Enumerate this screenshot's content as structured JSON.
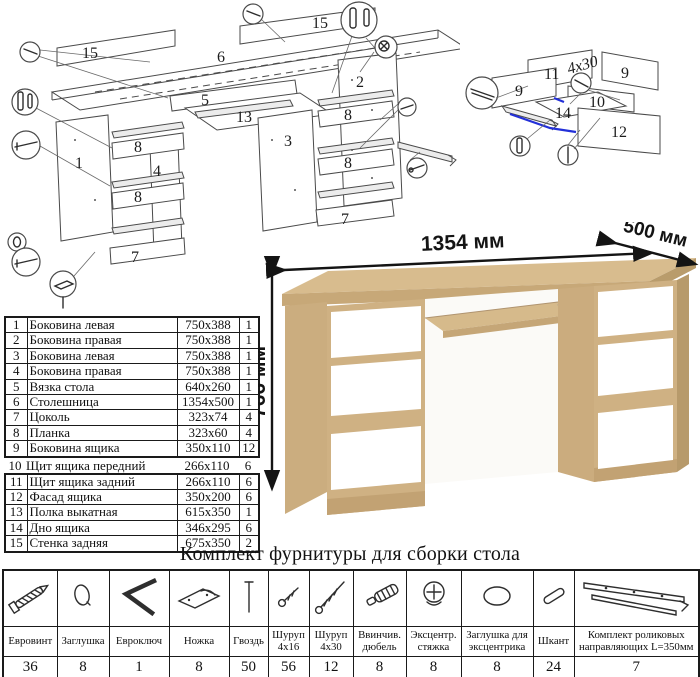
{
  "dimensions": {
    "width_label": "1354 мм",
    "depth_label": "500 мм",
    "height_label": "766 мм"
  },
  "diagram_main": {
    "labels": {
      "back_left": "15",
      "back_right": "15",
      "desktop": "6",
      "tie": "5",
      "side_right": "2",
      "shelf": "13",
      "side_left": "1",
      "partition_mid": "3",
      "partition_left": "4",
      "plank_l1": "8",
      "plank_l2": "8",
      "plank_c1": "8",
      "plank_c2": "8",
      "plinth_left": "7",
      "plinth_center": "7"
    }
  },
  "diagram_drawer": {
    "labels": {
      "back": "11",
      "side_left": "9",
      "side_right": "9",
      "front_inner": "10",
      "bottom": "14",
      "facade": "12"
    },
    "screw_note": "4x30"
  },
  "parts_table": {
    "rows": [
      {
        "num": "1",
        "name": "Боковина левая",
        "size": "750x388",
        "qty": "1"
      },
      {
        "num": "2",
        "name": "Боковина правая",
        "size": "750x388",
        "qty": "1"
      },
      {
        "num": "3",
        "name": "Боковина левая",
        "size": "750x388",
        "qty": "1"
      },
      {
        "num": "4",
        "name": "Боковина правая",
        "size": "750x388",
        "qty": "1"
      },
      {
        "num": "5",
        "name": "Вязка стола",
        "size": "640x260",
        "qty": "1"
      },
      {
        "num": "6",
        "name": "Столешница",
        "size": "1354x500",
        "qty": "1"
      },
      {
        "num": "7",
        "name": "Цоколь",
        "size": "323x74",
        "qty": "4"
      },
      {
        "num": "8",
        "name": "Планка",
        "size": "323x60",
        "qty": "4"
      },
      {
        "num": "9",
        "name": "Боковина ящика",
        "size": "350x110",
        "qty": "12"
      },
      {
        "num": "10",
        "name": "Щит ящика передний",
        "size": "266x110",
        "qty": "6"
      },
      {
        "num": "11",
        "name": "Щит ящика задний",
        "size": "266x110",
        "qty": "6"
      },
      {
        "num": "12",
        "name": "Фасад ящика",
        "size": "350x200",
        "qty": "6"
      },
      {
        "num": "13",
        "name": "Полка выкатная",
        "size": "615x350",
        "qty": "1"
      },
      {
        "num": "14",
        "name": "Дно ящика",
        "size": "346x295",
        "qty": "6"
      },
      {
        "num": "15",
        "name": "Стенка задняя",
        "size": "675x350",
        "qty": "2"
      }
    ]
  },
  "hardware": {
    "title": "Комплект фурнитуры для сборки стола",
    "items": [
      {
        "name": "Евровинт",
        "qty": "36",
        "icon": "euro-screw-icon"
      },
      {
        "name": "Заглушка",
        "qty": "8",
        "icon": "cap-icon"
      },
      {
        "name": "Евроключ",
        "qty": "1",
        "icon": "hex-key-icon"
      },
      {
        "name": "Ножка",
        "qty": "8",
        "icon": "foot-icon"
      },
      {
        "name": "Гвоздь",
        "qty": "50",
        "icon": "nail-icon"
      },
      {
        "name": "Шуруп 4x16",
        "qty": "56",
        "icon": "screw-short-icon"
      },
      {
        "name": "Шуруп 4x30",
        "qty": "12",
        "icon": "screw-long-icon"
      },
      {
        "name": "Ввинчив. дюбель",
        "qty": "8",
        "icon": "dowel-screw-icon"
      },
      {
        "name": "Эксцентр. стяжка",
        "qty": "8",
        "icon": "cam-lock-icon"
      },
      {
        "name": "Заглушка для эксцентрика",
        "qty": "8",
        "icon": "cam-cap-icon"
      },
      {
        "name": "Шкант",
        "qty": "24",
        "icon": "wood-dowel-icon"
      },
      {
        "name": "Комплект роликовых направляющих L=350мм",
        "qty": "7",
        "icon": "drawer-slide-icon"
      }
    ]
  },
  "colors": {
    "oak_top": "#d8bc8e",
    "oak_front": "#cfb183",
    "oak_edge": "#b99c6c",
    "drawer_white": "#ffffff",
    "diagram_line": "#4a4a4a",
    "accent_blue": "#2330d8"
  }
}
